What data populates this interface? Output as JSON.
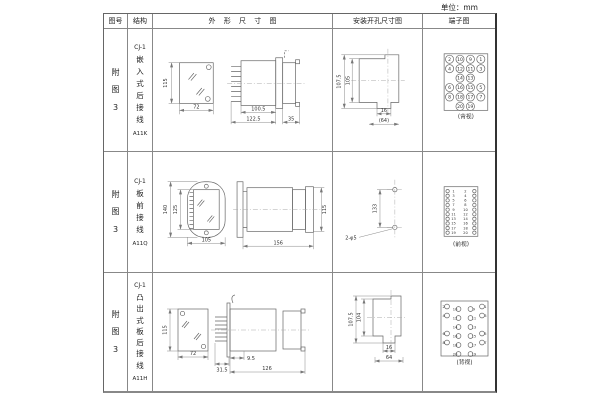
{
  "unit_label": "单位：mm",
  "table": {
    "headers": [
      "图号",
      "结构",
      "外 形 尺 寸 图",
      "安装开孔尺寸图",
      "端子图"
    ],
    "rows": [
      {
        "figure_no": "附图3",
        "structure": {
          "model": "CJ-1",
          "type": "嵌入式后接线",
          "code": "A11K"
        },
        "outline": {
          "h": "115",
          "w": "72",
          "l1": "100.5",
          "l2": "122.5",
          "l3": "35"
        },
        "install": {
          "h1": "107.5",
          "h2": "105",
          "w1": "16",
          "w2": "(64)"
        },
        "terminal": {
          "view": "(背视)",
          "pins_grid": [
            [
              "2",
              "10",
              "9",
              "1"
            ],
            [
              "4",
              "12",
              "11",
              "3"
            ],
            [
              "",
              "14",
              "13",
              ""
            ],
            [
              "6",
              "16",
              "15",
              "5"
            ],
            [
              "8",
              "18",
              "17",
              "7"
            ],
            [
              "",
              "20",
              "19",
              ""
            ]
          ]
        }
      },
      {
        "figure_no": "附图3",
        "structure": {
          "model": "CJ-1",
          "type": "板前接线",
          "code": "A11Q"
        },
        "outline": {
          "h1": "140",
          "h2": "125",
          "w": "105",
          "l": "156",
          "h3": "115"
        },
        "install": {
          "spacing": "133",
          "holes": "2-φ5"
        },
        "terminal": {
          "view": "(前视)",
          "pin_rows": [
            [
              "1",
              "2"
            ],
            [
              "3",
              "4"
            ],
            [
              "5",
              "6"
            ],
            [
              "7",
              "8"
            ],
            [
              "9",
              "10"
            ],
            [
              "11",
              "12"
            ],
            [
              "13",
              "14"
            ],
            [
              "15",
              "16"
            ],
            [
              "17",
              "18"
            ],
            [
              "19",
              "20"
            ]
          ]
        }
      },
      {
        "figure_no": "附图3",
        "structure": {
          "model": "CJ-1",
          "type": "凸出式板后接线",
          "code": "A11H"
        },
        "outline": {
          "h": "115",
          "w": "72",
          "l1": "31.5",
          "l2": "9.5",
          "l3": "126"
        },
        "install": {
          "h1": "107.5",
          "h2": "104",
          "w1": "16",
          "w2": "64"
        },
        "terminal": {
          "view": "(背视)",
          "pins_grid": [
            [
              "2",
              "10",
              "9",
              "1"
            ],
            [
              "4",
              "12",
              "11",
              "3"
            ],
            [
              "",
              "14",
              "13",
              ""
            ],
            [
              "6",
              "16",
              "15",
              "5"
            ],
            [
              "8",
              "18",
              "17",
              "7"
            ],
            [
              "",
              "20",
              "19",
              ""
            ]
          ]
        }
      }
    ]
  }
}
